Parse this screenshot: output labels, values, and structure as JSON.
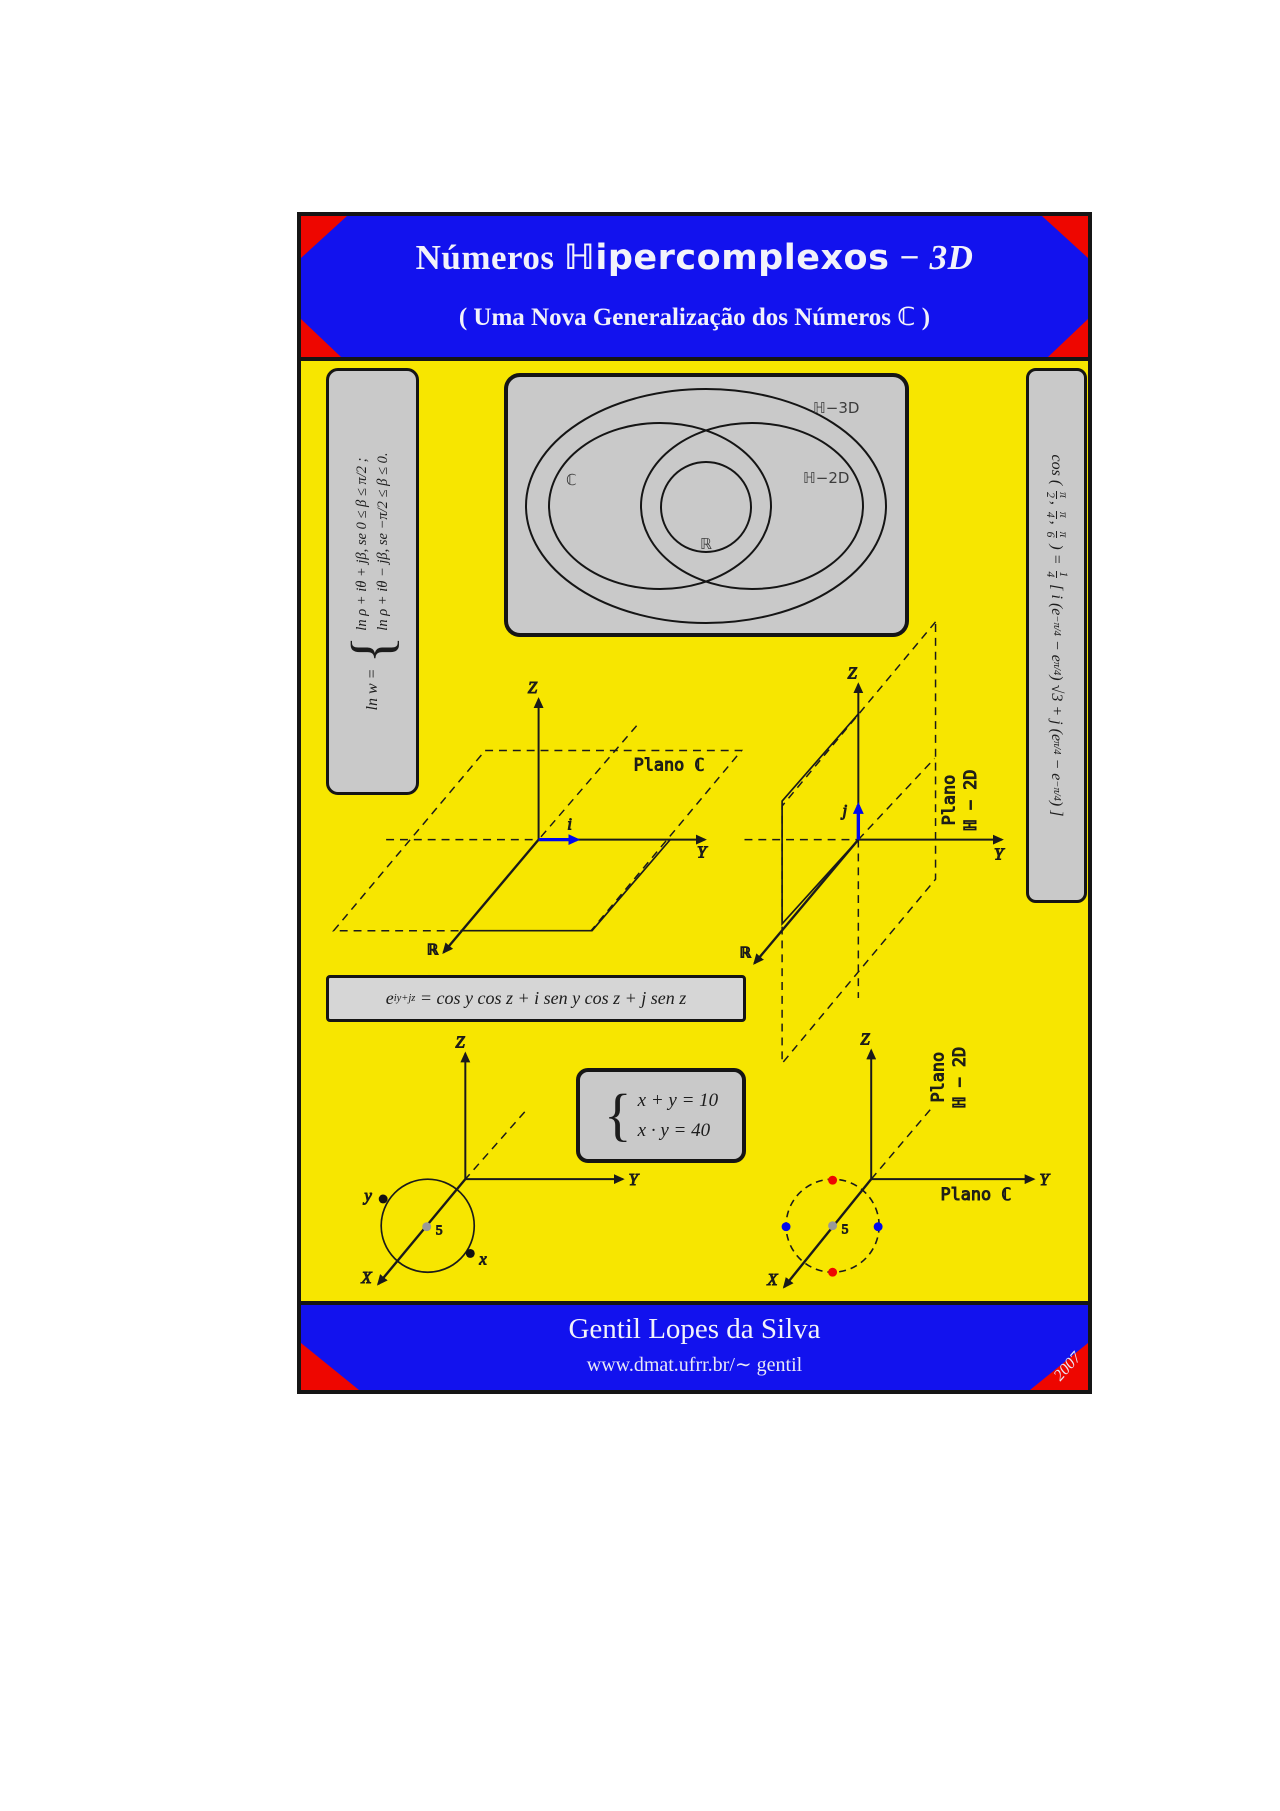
{
  "colors": {
    "background_yellow": "#F7E600",
    "band_blue": "#1212EE",
    "corner_red": "#EE0600",
    "box_gray": "#C9C9C9",
    "accent_blue_vector": "#0008EE",
    "dot_red": "#EE0600",
    "dot_blue": "#0008EE",
    "dot_gray": "#999999"
  },
  "header": {
    "title_1": "Números",
    "title_2": "ℍipercomplexos",
    "title_3": "− 3D",
    "subtitle": "( Uma Nova Generalização dos Números ℂ )"
  },
  "footer": {
    "author": "Gentil Lopes da Silva",
    "url": "www.dmat.ufrr.br/∼ gentil",
    "year": "2007"
  },
  "ln_box": {
    "prefix": "ln w =",
    "brace": "{",
    "case1": "ln ρ + iθ + jβ,  se  0 ≤ β ≤ π/2 ;",
    "case2": "ln ρ + iθ − jβ,  se  −π/2 ≤ β ≤ 0."
  },
  "cos_box": {
    "p1": "cos ( ",
    "f1n": "π",
    "f1d": "2",
    "comma": ", ",
    "f2n": "π",
    "f2d": "4",
    "f3n": "π",
    "f3d": "6",
    "p2": " ) = ",
    "f4n": "1",
    "f4d": "4",
    "p3": " [ i (e",
    "s1": "−π/4",
    "p4": " − e",
    "s2": "π/4",
    "p5": ") √3 + j (e",
    "s3": "π/4",
    "p6": " − e",
    "s4": "−π/4",
    "p7": ") ]"
  },
  "euler_box": {
    "base": "e",
    "sup": "iy+jz",
    "rest": " = cos y cos z + i sen y cos z + j sen z"
  },
  "system_box": {
    "brace": "{",
    "eq1": "x + y = 10",
    "eq2": "x · y = 40"
  },
  "venn": {
    "outer_label": "ℍ−3D",
    "right_label": "ℍ−2D",
    "left_label": "ℂ",
    "center_label": "ℝ"
  },
  "plots": {
    "p1": {
      "z": "Z",
      "y": "Y",
      "x": "ℝ",
      "i": "i",
      "plane": "Plano ℂ"
    },
    "p2": {
      "z": "Z",
      "y": "Y",
      "x": "ℝ",
      "j": "j",
      "plane_1": "Plano",
      "plane_2": "ℍ − 2D"
    },
    "p3": {
      "z": "Z",
      "y": "Y",
      "x": "X",
      "dot_y": "y",
      "dot_x": "x",
      "center": "5"
    },
    "p4": {
      "z": "Z",
      "y": "Y",
      "x": "X",
      "center": "5",
      "plane_1": "Plano",
      "plane_2": "ℍ − 2D",
      "plane_c": "Plano ℂ"
    }
  }
}
